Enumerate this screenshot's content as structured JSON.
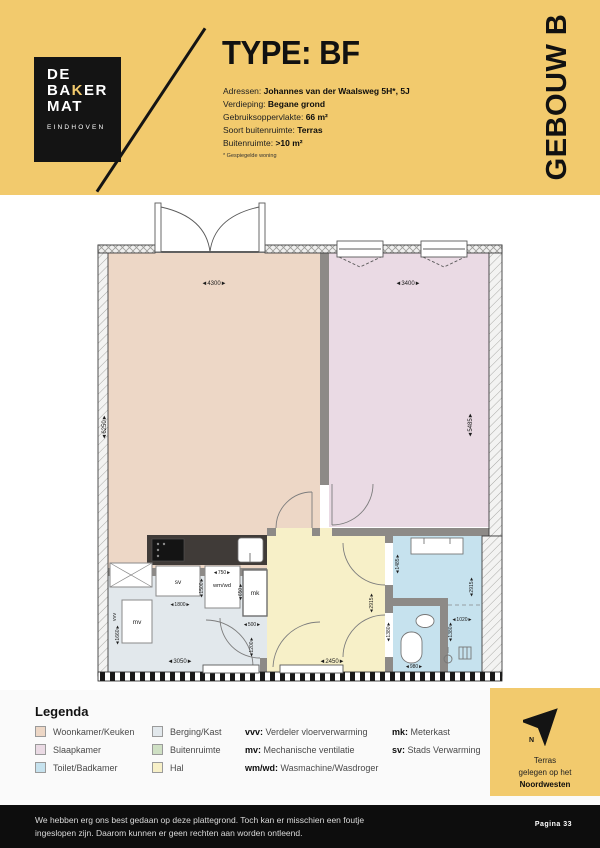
{
  "header": {
    "logo": {
      "l1": "DE",
      "l2a": "BA",
      "k": "K",
      "l2b": "ER",
      "l3": "MAT",
      "city": "EINDHOVEN"
    },
    "title": "TYPE: BF",
    "details": [
      {
        "label": "Adressen: ",
        "value": "Johannes van der Waalsweg 5H*, 5J"
      },
      {
        "label": "Verdieping: ",
        "value": "Begane grond"
      },
      {
        "label": "Gebruiksoppervlakte: ",
        "value": "66 m²"
      },
      {
        "label": "Soort buitenruimte: ",
        "value": "Terras"
      },
      {
        "label": "Buitenruimte: ",
        "value": ">10 m²"
      }
    ],
    "footnote": "* Gespiegelde woning",
    "building": "GEBOUW B"
  },
  "plan": {
    "labels": {
      "sv": "sv",
      "mv": "mv",
      "vvv": "vvv",
      "wmwd": "wm/wd",
      "mk": "mk"
    },
    "dims": {
      "living_w": "4300",
      "living_h": "6250",
      "bed_w": "3400",
      "bed_h": "5485",
      "berging_niche": "1800",
      "berging_left": "1660",
      "berging_w": "3050",
      "wmwd_w": "750",
      "wmwd_left": "1500",
      "wmwd_right": "650",
      "mk_w": "500",
      "hall_entry": "1200",
      "hall_w": "2450",
      "hall_h": "2915",
      "bath_top": "1485",
      "bath_h": "2915",
      "toilet_left": "1380",
      "toilet_right": "1380",
      "shower_w": "1020",
      "toilet_w": "980"
    }
  },
  "legend": {
    "title": "Legenda",
    "rooms": [
      {
        "label": "Woonkamer/Keuken",
        "color": "#EDD7C6"
      },
      {
        "label": "Slaapkamer",
        "color": "#EADAE4"
      },
      {
        "label": "Toilet/Badkamer",
        "color": "#C6E2EE"
      },
      {
        "label": "Berging/Kast",
        "color": "#E2E8EC"
      },
      {
        "label": "Buitenruimte",
        "color": "#CFE0C4"
      },
      {
        "label": "Hal",
        "color": "#F7F0C8"
      }
    ],
    "abbrevs": [
      {
        "abbr": "vvv:",
        "desc": " Verdeler vloerverwarming"
      },
      {
        "abbr": "mv:",
        "desc": " Mechanische ventilatie"
      },
      {
        "abbr": "wm/wd:",
        "desc": " Wasmachine/Wasdroger"
      },
      {
        "abbr": "mk:",
        "desc": " Meterkast"
      },
      {
        "abbr": "sv:",
        "desc": " Stads Verwarming"
      }
    ],
    "compass": {
      "line1": "Terras",
      "line2": "gelegen op het",
      "line3": "Noordwesten",
      "n": "N"
    }
  },
  "footer": {
    "disclaimer_line1": "We hebben erg ons best gedaan op deze plattegrond. Toch kan er misschien een foutje",
    "disclaimer_line2": "ingeslopen zijn. Daarom kunnen er geen rechten aan worden ontleend.",
    "page": "Pagina  33"
  }
}
